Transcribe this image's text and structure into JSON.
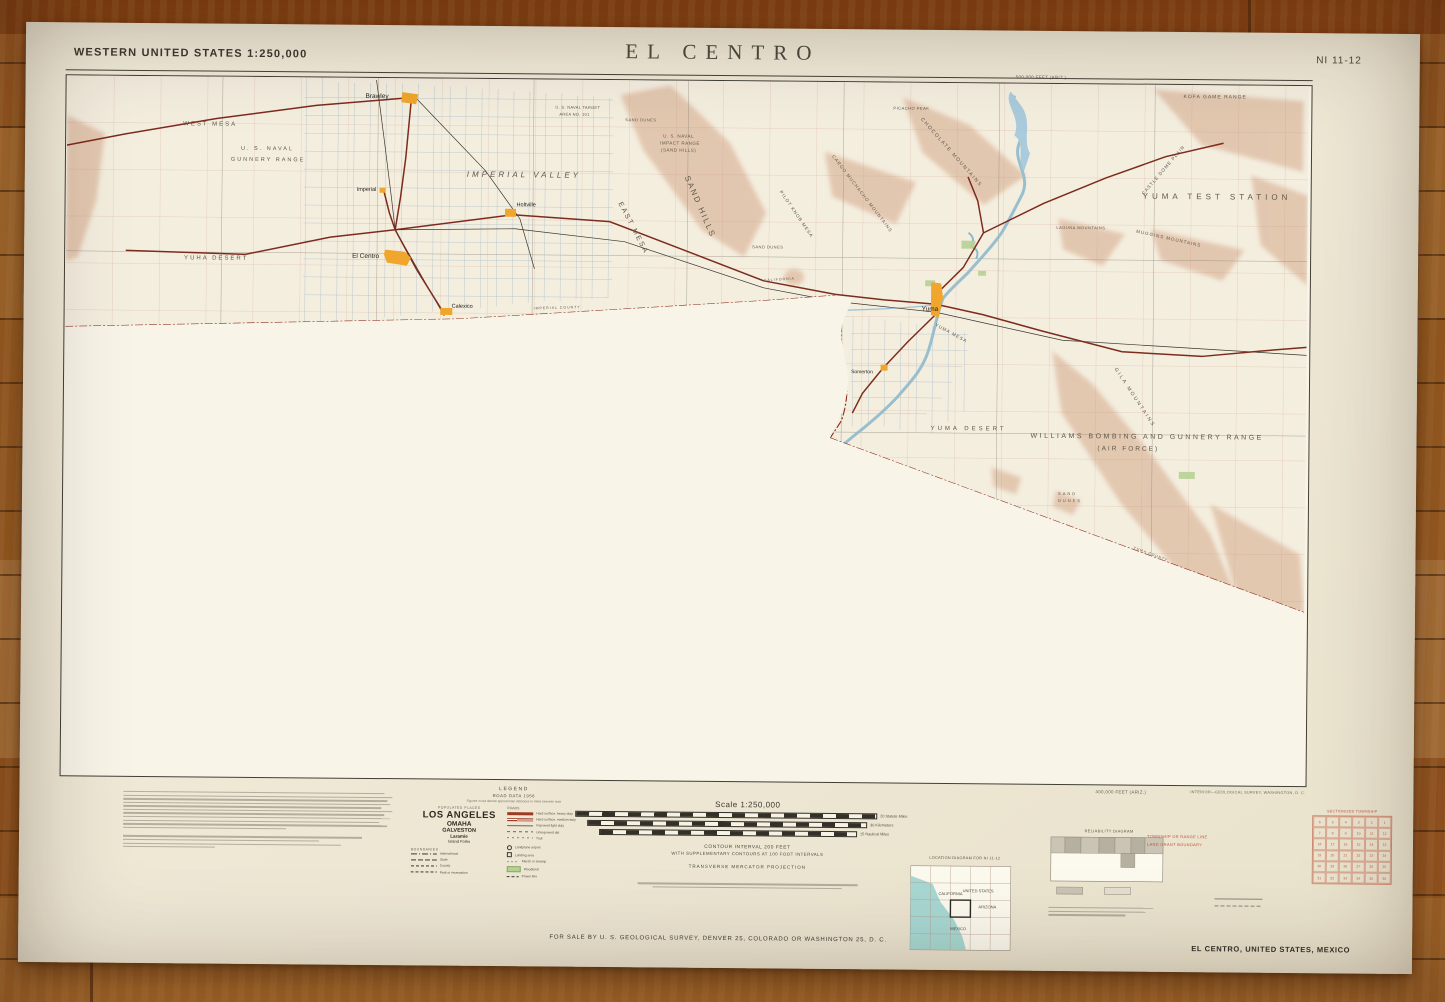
{
  "photo": {
    "surface": "hardwood floor, horizontal oak planks",
    "object": "folded USGS paper topographic map sheet"
  },
  "colors": {
    "wood": "#b06b29",
    "paper": "#efe9d7",
    "town_orange": "#f0a62c",
    "water_blue": "#9cc0d2",
    "woodland_green": "#b7d195",
    "relief_tan": "#e0c1a8",
    "road_red": "#8a3020",
    "red_overprint": "#c0533a",
    "ocean_teal": "#9fd4cf"
  },
  "map_sheet": {
    "series_label": "WESTERN UNITED STATES 1:250,000",
    "title": "EL CENTRO",
    "sheet_number": "NI 11-12",
    "margin_notes": {
      "top_right_feet": "500,000 FEET (ARIZ.)",
      "bottom_right_feet": "400,000 FEET (ARIZ.)"
    },
    "area_labels": [
      {
        "text": "WEST MESA"
      },
      {
        "text": "U. S. NAVAL"
      },
      {
        "text": "GUNNERY RANGE"
      },
      {
        "text": "YUHA DESERT"
      },
      {
        "text": "IMPERIAL VALLEY"
      },
      {
        "text": "EAST MESA"
      },
      {
        "text": "SAND HILLS"
      },
      {
        "text": "U. S. NAVAL"
      },
      {
        "text": "IMPACT RANGE"
      },
      {
        "text": "(SAND HILLS)"
      },
      {
        "text": "SAND DUNES"
      },
      {
        "text": "SAND DUNES"
      },
      {
        "text": "PILOT KNOB MESA"
      },
      {
        "text": "CARGO MUCHACHO MOUNTAINS"
      },
      {
        "text": "CHOCOLATE MOUNTAINS"
      },
      {
        "text": "PICACHO PEAK"
      },
      {
        "text": "KOFA GAME RANGE"
      },
      {
        "text": "CASTLE DOME PLAIN"
      },
      {
        "text": "YUMA TEST STATION"
      },
      {
        "text": "MUGGINS MOUNTAINS"
      },
      {
        "text": "LAGUNA MOUNTAINS"
      },
      {
        "text": "GILA MOUNTAINS"
      },
      {
        "text": "YUMA MESA"
      },
      {
        "text": "YUMA DESERT"
      },
      {
        "text": "WILLIAMS BOMBING AND GUNNERY RANGE"
      },
      {
        "text": "(AIR FORCE)"
      },
      {
        "text": "SAND"
      },
      {
        "text": "DUNES"
      },
      {
        "text": "U. S. NAVAL TARGET"
      },
      {
        "text": "AREA NO. 101"
      },
      {
        "text": "IMPERIAL COUNTY"
      },
      {
        "text": "YUMA COUNTY"
      },
      {
        "text": "CALIFORNIA"
      }
    ],
    "place_labels": [
      {
        "text": "Brawley"
      },
      {
        "text": "Imperial"
      },
      {
        "text": "El Centro"
      },
      {
        "text": "Holtville"
      },
      {
        "text": "Calexico"
      },
      {
        "text": "Yuma"
      },
      {
        "text": "Somerton"
      }
    ],
    "legend": {
      "title": "LEGEND",
      "subtitle": "ROAD DATA 1956",
      "note": "Figures in red denote approximate distances in miles between dots",
      "populated_places_heading": "POPULATED PLACES",
      "populated_places": [
        "LOS ANGELES",
        "OMAHA",
        "GALVESTON",
        "Laramie",
        "Grand Forks"
      ],
      "roads_heading": "ROADS",
      "road_classes": [
        "Hard surface, heavy duty",
        "Hard surface, medium duty",
        "Improved light duty",
        "Unimproved dirt",
        "Trail"
      ],
      "boundaries_heading": "BOUNDARIES",
      "boundaries": [
        "International",
        "State",
        "County",
        "Park or reservation"
      ],
      "symbols": [
        "Landplane airport",
        "Landing area",
        "Marsh or swamp",
        "Woodland",
        "Power line"
      ]
    },
    "scale_block": {
      "scale_label": "Scale 1:250,000",
      "bars": [
        "20 Statute Miles",
        "30 Kilometers",
        "15 Nautical Miles"
      ],
      "contour_line1": "CONTOUR INTERVAL 200 FEET",
      "contour_line2": "WITH SUPPLEMENTARY CONTOURS AT 100 FOOT INTERVALS",
      "projection": "TRANSVERSE MERCATOR PROJECTION"
    },
    "location_diagram": {
      "title": "LOCATION DIAGRAM FOR NI 11-12",
      "labels": [
        "CALIFORNIA",
        "UNITED STATES",
        "ARIZONA",
        "MEXICO"
      ]
    },
    "reliability_diagram": {
      "title": "RELIABILITY DIAGRAM"
    },
    "red_notes": {
      "line1": "TOWNSHIP OR RANGE LINE",
      "line2": "LAND GRANT BOUNDARY"
    },
    "sectionized": {
      "title": "SECTIONIZED TOWNSHIP",
      "rows": [
        [
          "6",
          "5",
          "4",
          "3",
          "2",
          "1"
        ],
        [
          "7",
          "8",
          "9",
          "10",
          "11",
          "12"
        ],
        [
          "18",
          "17",
          "16",
          "15",
          "14",
          "13"
        ],
        [
          "19",
          "20",
          "21",
          "22",
          "23",
          "24"
        ],
        [
          "30",
          "29",
          "28",
          "27",
          "26",
          "25"
        ],
        [
          "31",
          "32",
          "33",
          "34",
          "35",
          "36"
        ]
      ]
    },
    "footer": {
      "sale_line": "FOR SALE BY U. S. GEOLOGICAL SURVEY, DENVER 25, COLORADO OR WASHINGTON 25, D. C.",
      "credit_line": "INTERIOR—GEOLOGICAL SURVEY, WASHINGTON, D. C.",
      "sheet_caption": "EL CENTRO, UNITED STATES, MEXICO"
    }
  }
}
